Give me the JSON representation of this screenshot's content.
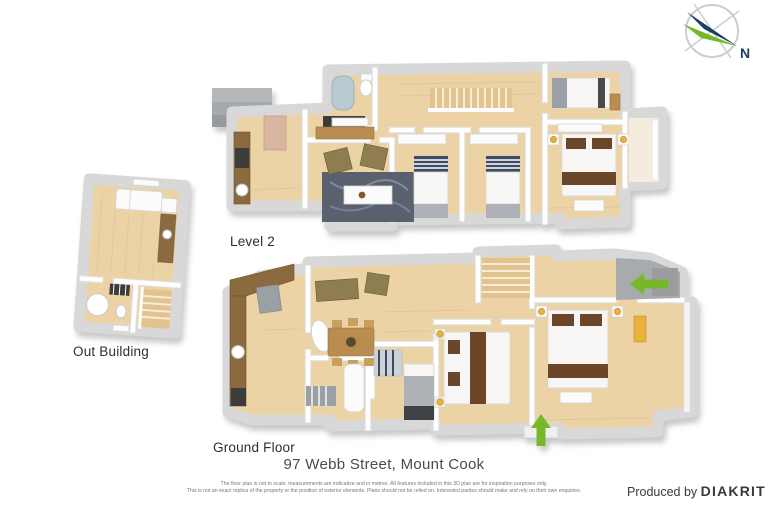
{
  "compass": {
    "label": "N"
  },
  "floors": {
    "level2": {
      "label": "Level 2"
    },
    "outBuilding": {
      "label": "Out Building"
    },
    "groundFloor": {
      "label": "Ground Floor"
    }
  },
  "title": "97 Webb Street, Mount Cook",
  "disclaimer": {
    "line1": "The floor plan is not to scale; measurements are indicative and in metres. All features included in this 3D plan are for inspiration purposes only.",
    "line2": "This is not an exact replica of the property or the position of exterior elements. Plans should not be relied on. Interested parties should make and rely on their own enquiries."
  },
  "credit": {
    "prefix": "Produced by",
    "brand": "DIAKRIT"
  },
  "colors": {
    "accent_green": "#76b82a",
    "compass_navy": "#1b3f63",
    "compass_ring": "#c9ced4",
    "floor_wood": "#ecd3a6",
    "wall_white": "#ffffff",
    "counter_brown": "#8a6a3e",
    "deck_gray": "#a7abad",
    "bed_runner_brown": "#6b4628",
    "rug_slate": "#59606e"
  }
}
